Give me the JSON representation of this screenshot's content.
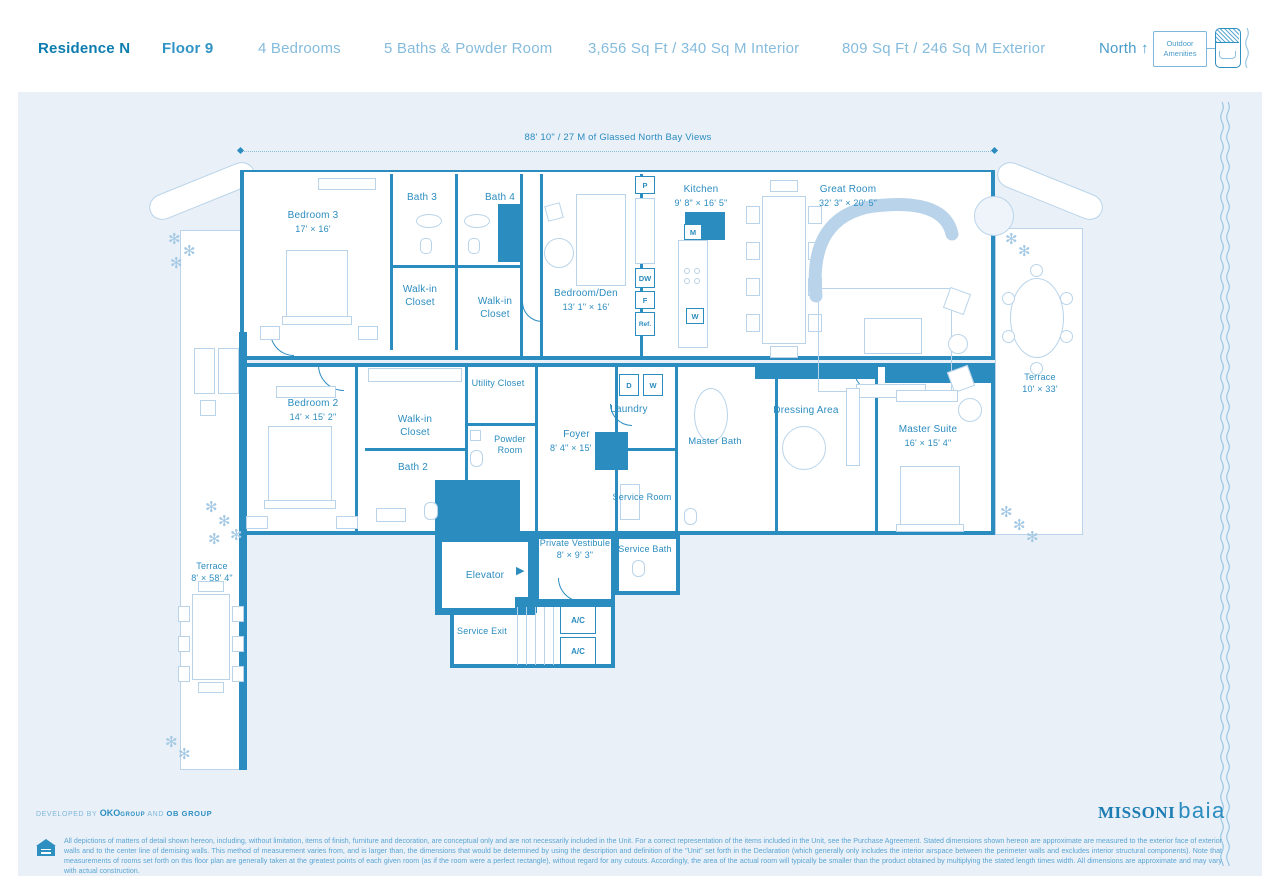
{
  "header": {
    "residence": "Residence N",
    "floor": "Floor 9",
    "bedrooms": "4 Bedrooms",
    "baths": "5 Baths & Powder Room",
    "interior": "3,656 Sq Ft / 340 Sq M Interior",
    "exterior": "809 Sq Ft / 246 Sq M Exterior",
    "north_label": "North ↑",
    "legend_label": "Outdoor Amenities"
  },
  "plan": {
    "glass_note": "88' 10\" / 27 M of Glassed North Bay Views",
    "rooms": {
      "bedroom3": {
        "name": "Bedroom 3",
        "dims": "17' × 16'"
      },
      "bath3": {
        "name": "Bath 3"
      },
      "bath4": {
        "name": "Bath 4"
      },
      "wic1": {
        "name": "Walk-in Closet"
      },
      "wic2": {
        "name": "Walk-in Closet"
      },
      "bedroom_den": {
        "name": "Bedroom/Den",
        "dims": "13' 1\" × 16'"
      },
      "kitchen": {
        "name": "Kitchen",
        "dims": "9' 8\" × 16' 5\""
      },
      "great_room": {
        "name": "Great Room",
        "dims": "32' 3\" × 20' 5\""
      },
      "bedroom2": {
        "name": "Bedroom 2",
        "dims": "14' × 15' 2\""
      },
      "wic3": {
        "name": "Walk-in Closet"
      },
      "bath2": {
        "name": "Bath 2"
      },
      "utility": {
        "name": "Utility Closet"
      },
      "powder": {
        "name": "Powder Room"
      },
      "foyer": {
        "name": "Foyer",
        "dims": "8' 4\" × 15' 5\""
      },
      "laundry": {
        "name": "Laundry"
      },
      "master_bath": {
        "name": "Master Bath"
      },
      "dressing": {
        "name": "Dressing Area"
      },
      "master_suite": {
        "name": "Master Suite",
        "dims": "16' × 15' 4\""
      },
      "terrace_right": {
        "name": "Terrace",
        "dims": "10' × 33'"
      },
      "terrace_left": {
        "name": "Terrace",
        "dims": "8' × 58' 4\""
      },
      "service_room": {
        "name": "Service Room"
      },
      "service_bath": {
        "name": "Service Bath"
      },
      "vestibule": {
        "name": "Private Vestibule",
        "dims": "8' × 9' 3\""
      },
      "elevator": {
        "name": "Elevator"
      },
      "service_exit": {
        "name": "Service Exit"
      },
      "ac1": {
        "name": "A/C"
      },
      "ac2": {
        "name": "A/C"
      }
    },
    "appliances": {
      "pantry": "P",
      "dishwasher": "DW",
      "freezer": "F",
      "fridge": "Ref.",
      "microwave": "M",
      "wine": "W",
      "dryer": "D",
      "washer": "W"
    }
  },
  "footer": {
    "developed_prefix": "DEVELOPED BY",
    "developer_1": "OKO",
    "developer_1_suffix": "GROUP",
    "developed_mid": "AND",
    "developer_2": "OB GROUP",
    "brand_1": "MISSONI",
    "brand_2": "baia",
    "disclaimer": "All depictions of matters of detail shown hereon, including, without limitation, items of finish, furniture and decoration, are conceptual only and are not necessarily included in the Unit. For a correct representation of the items included in the Unit, see the Purchase Agreement. Stated dimensions shown hereon are approximate are measured to the exterior face of exterior walls and to the center line of demising walls. This method of measurement varies from, and is larger than, the dimensions that would be determined by using the description and definition of the \"Unit\" set forth in the Declaration (which generally only includes the interior airspace between the perimeter walls and excludes interior structural components). Note that measurements of rooms set forth on this floor plan are generally taken at the greatest points of each given room (as if the room were a perfect rectangle), without regard for any cutouts. Accordingly, the area of the actual room will typically be smaller than the product obtained by multiplying the stated length times width.  All dimensions are approximate and may vary with actual construction."
  },
  "icons": {
    "plant": "✻",
    "elevator_arrow": "▶"
  },
  "colors": {
    "accent": "#2b8cbf",
    "header_dark": "#0d7cae",
    "panel_bg": "#e9f0f8",
    "light_text": "#7fb7da",
    "furniture": "#b9d4ea"
  }
}
